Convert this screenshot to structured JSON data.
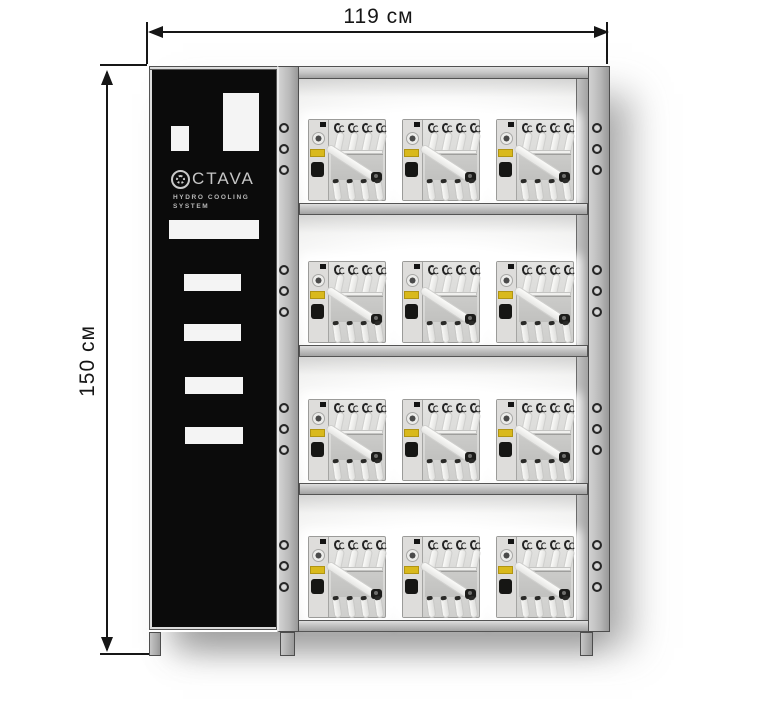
{
  "dimensions": {
    "width_label": "119 см",
    "height_label": "150 см"
  },
  "panel": {
    "brand_wordmark": "CTAVA",
    "subtitle_line1": "HYDRO COOLING",
    "subtitle_line2": "SYSTEM"
  },
  "rack": {
    "rows": 4,
    "units_per_row": 3,
    "holes_per_post_per_row": 3,
    "unit_name": "hydro-cooling-unit"
  },
  "icons": {
    "brand_logo": "gear-flower-ring",
    "mount_hole": "small-circle",
    "dimension_arrows": "double-headed-arrow"
  },
  "colors": {
    "background": "#ffffff",
    "panel_black": "#0b0b0b",
    "frame_gray": "#b9b9b9",
    "unit_body": "#d8d8d6",
    "warning_label_yellow": "#d9b91c",
    "dimension_line": "#161616"
  }
}
